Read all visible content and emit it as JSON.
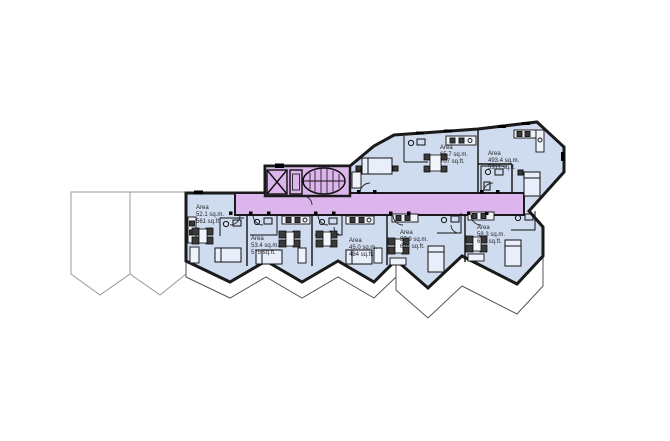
{
  "plan": {
    "colors": {
      "background": "#ffffff",
      "apartment_fill": "#cfdcf0",
      "corridor_fill": "#dcb5ec",
      "wall": "#1a1a1a",
      "ghost_outline": "#999999",
      "furniture_dark": "#3a3a3a"
    },
    "unit_labels": [
      {
        "heading": "Area",
        "metric": "52.1 sq.m.",
        "imperial": "561 sq.ft."
      },
      {
        "heading": "Area",
        "metric": "53.4 sq.m.",
        "imperial": "575 sq.ft."
      },
      {
        "heading": "Area",
        "metric": "45.0 sq.m.",
        "imperial": "484 sq.ft."
      },
      {
        "heading": "Area",
        "metric": "57.9 sq.m.",
        "imperial": "624 sq.ft."
      },
      {
        "heading": "Area",
        "metric": "58.3 sq.m.",
        "imperial": "627 sq.ft."
      },
      {
        "heading": "Area",
        "metric": "65.7 sq.m.",
        "imperial": "707 sq.ft."
      },
      {
        "heading": "Area",
        "metric": "493.4 sq.m.",
        "imperial": "5311 sq.ft."
      }
    ]
  }
}
